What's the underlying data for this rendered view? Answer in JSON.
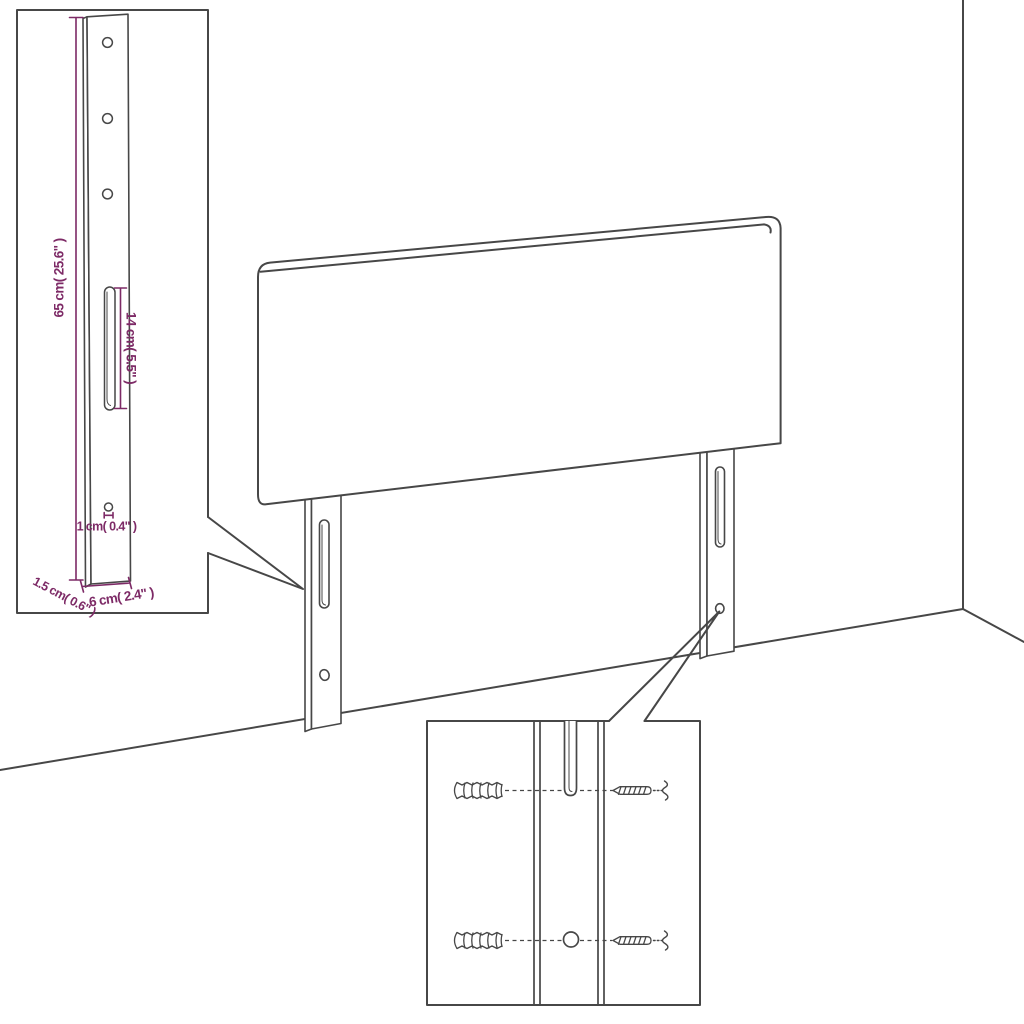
{
  "diagram": {
    "kind": "furniture dimension diagram",
    "subject": "headboard with two mounting legs, room corner backdrop, leg detail inset and hardware detail inset",
    "colors": {
      "line": "#474747",
      "dimension_accent": "#7d2a66",
      "background": "#ffffff"
    },
    "dimensions": {
      "leg_height": "65 cm( 25.6\" )",
      "slot_length": "14 cm( 5.5\" )",
      "hole_diameter": "1 cm( 0.4\" )",
      "leg_depth": "1.5 cm( 0.6\" )",
      "leg_width": "6 cm( 2.4\" )"
    }
  }
}
